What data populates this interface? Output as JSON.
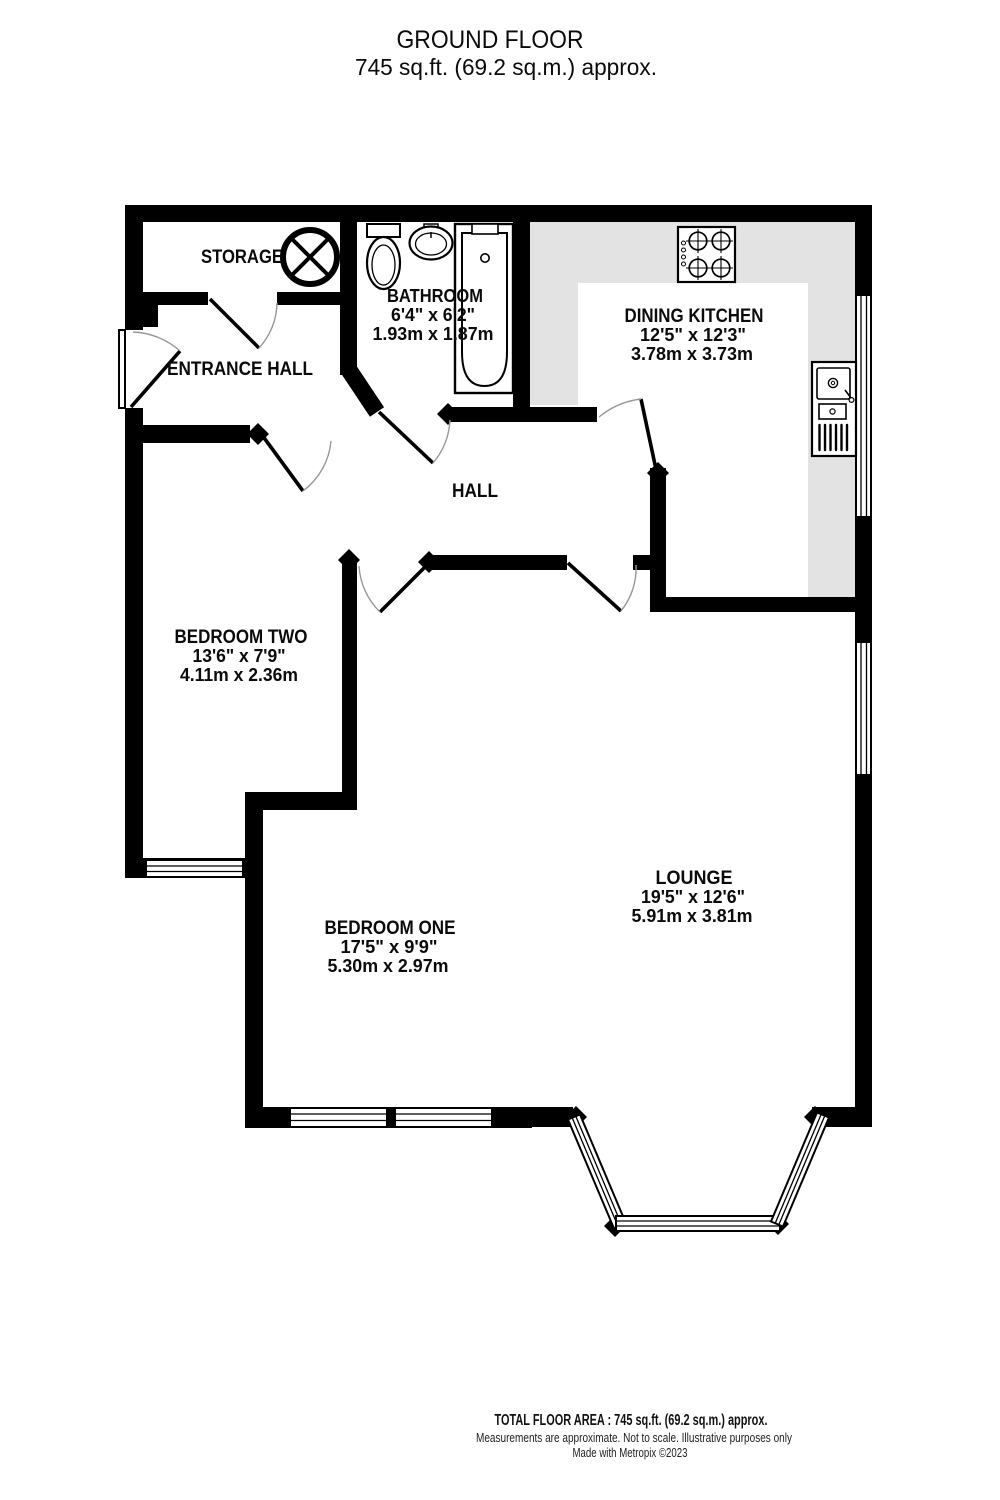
{
  "header": {
    "title": "GROUND FLOOR",
    "subtitle": "745 sq.ft. (69.2 sq.m.) approx."
  },
  "rooms": {
    "storage": {
      "name": "STORAGE"
    },
    "entrance_hall": {
      "name": "ENTRANCE HALL"
    },
    "bathroom": {
      "name": "BATHROOM",
      "size_imperial": "6'4\" x 6'2\"",
      "size_metric": "1.93m x 1.87m"
    },
    "dining_kitchen": {
      "name": "DINING KITCHEN",
      "size_imperial": "12'5\" x 12'3\"",
      "size_metric": "3.78m x 3.73m"
    },
    "hall": {
      "name": "HALL"
    },
    "bedroom_two": {
      "name": "BEDROOM TWO",
      "size_imperial": "13'6\" x 7'9\"",
      "size_metric": "4.11m x 2.36m"
    },
    "bedroom_one": {
      "name": "BEDROOM ONE",
      "size_imperial": "17'5\" x 9'9\"",
      "size_metric": "5.30m x 2.97m"
    },
    "lounge": {
      "name": "LOUNGE",
      "size_imperial": "19'5\" x 12'6\"",
      "size_metric": "5.91m x 3.81m"
    }
  },
  "fixtures": [
    "hot-water-cylinder",
    "toilet",
    "wash-basin",
    "bathtub",
    "hob-4-burner",
    "kitchen-sink-drainer"
  ],
  "footer": {
    "total_area": "TOTAL FLOOR AREA : 745 sq.ft. (69.2 sq.m.) approx.",
    "disclaimer": "Measurements are approximate.  Not to scale.  Illustrative purposes only",
    "credit": "Made with Metropix ©2023"
  },
  "colors": {
    "wall": "#000000",
    "counter": "#e3e3e3",
    "background": "#ffffff"
  }
}
